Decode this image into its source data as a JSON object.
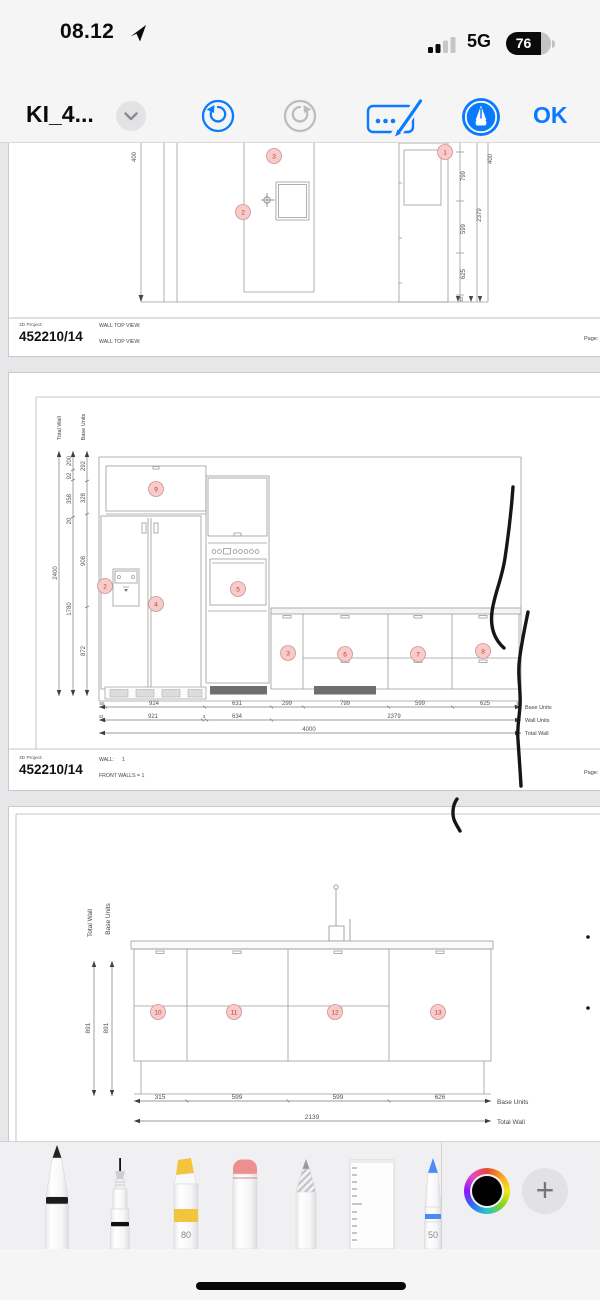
{
  "status_bar": {
    "time": "08.12",
    "network": "5G",
    "battery_percent": "76"
  },
  "nav": {
    "title": "KI_4...",
    "ok": "OK"
  },
  "page1": {
    "project_label": "3D Project:",
    "project_number": "452210/14",
    "view_line1": "WALL TOP VIEW:",
    "view_line2": "WALL TOP VIEW:",
    "page_label": "Page: 7",
    "badges": {
      "b1": "1",
      "b2": "2",
      "b3": "3"
    },
    "dims": {
      "left_400": "400",
      "right_799": "799",
      "right_599": "599",
      "right_625": "625",
      "right_52": "52",
      "right_2379": "2379",
      "right_400": "400"
    }
  },
  "page2": {
    "project_label": "3D Project:",
    "project_number": "452210/14",
    "wall_label": "WALL:",
    "wall_value": "1",
    "view_line": "FRONT WALLS = 1",
    "page_label": "Page: 8",
    "axis_labels": {
      "total_wall": "Total Wall",
      "base_units": "Base Units",
      "wall_units": "Wall Units"
    },
    "v_outer": "2400",
    "v_mid": [
      "200",
      "92",
      "358",
      "20",
      "1780"
    ],
    "v_inner": [
      "292",
      "328",
      "908",
      "872"
    ],
    "h_base": [
      "55",
      "924",
      "631",
      "299",
      "799",
      "599",
      "625",
      "52"
    ],
    "h_wall": [
      "42",
      "921",
      "3",
      "634",
      "2379"
    ],
    "h_total": "4000",
    "badges": {
      "b2": "2",
      "b3": "3",
      "b4": "4",
      "b5": "5",
      "b6": "6",
      "b7": "7",
      "b8": "8",
      "b9": "9"
    }
  },
  "page3": {
    "axis_labels": {
      "total_wall": "Total Wall",
      "base_units": "Base Units"
    },
    "v_dims": [
      "891",
      "891"
    ],
    "h_base": [
      "315",
      "599",
      "599",
      "626"
    ],
    "h_total": "2139",
    "badges": {
      "b10": "10",
      "b11": "11",
      "b12": "12",
      "b13": "13"
    }
  },
  "tools": {
    "highlighter_size": "80",
    "blue_pen_size": "50"
  },
  "colors": {
    "accent_blue": "#0a7aff",
    "badge_fill": "#f7cbca",
    "badge_stroke": "#d09090",
    "badge_text": "#b9413d",
    "ink_black": "#161616",
    "highlighter_yellow": "#f2c53d",
    "eraser_pink": "#ee8f8f",
    "pen_blue": "#4b8bf5"
  }
}
